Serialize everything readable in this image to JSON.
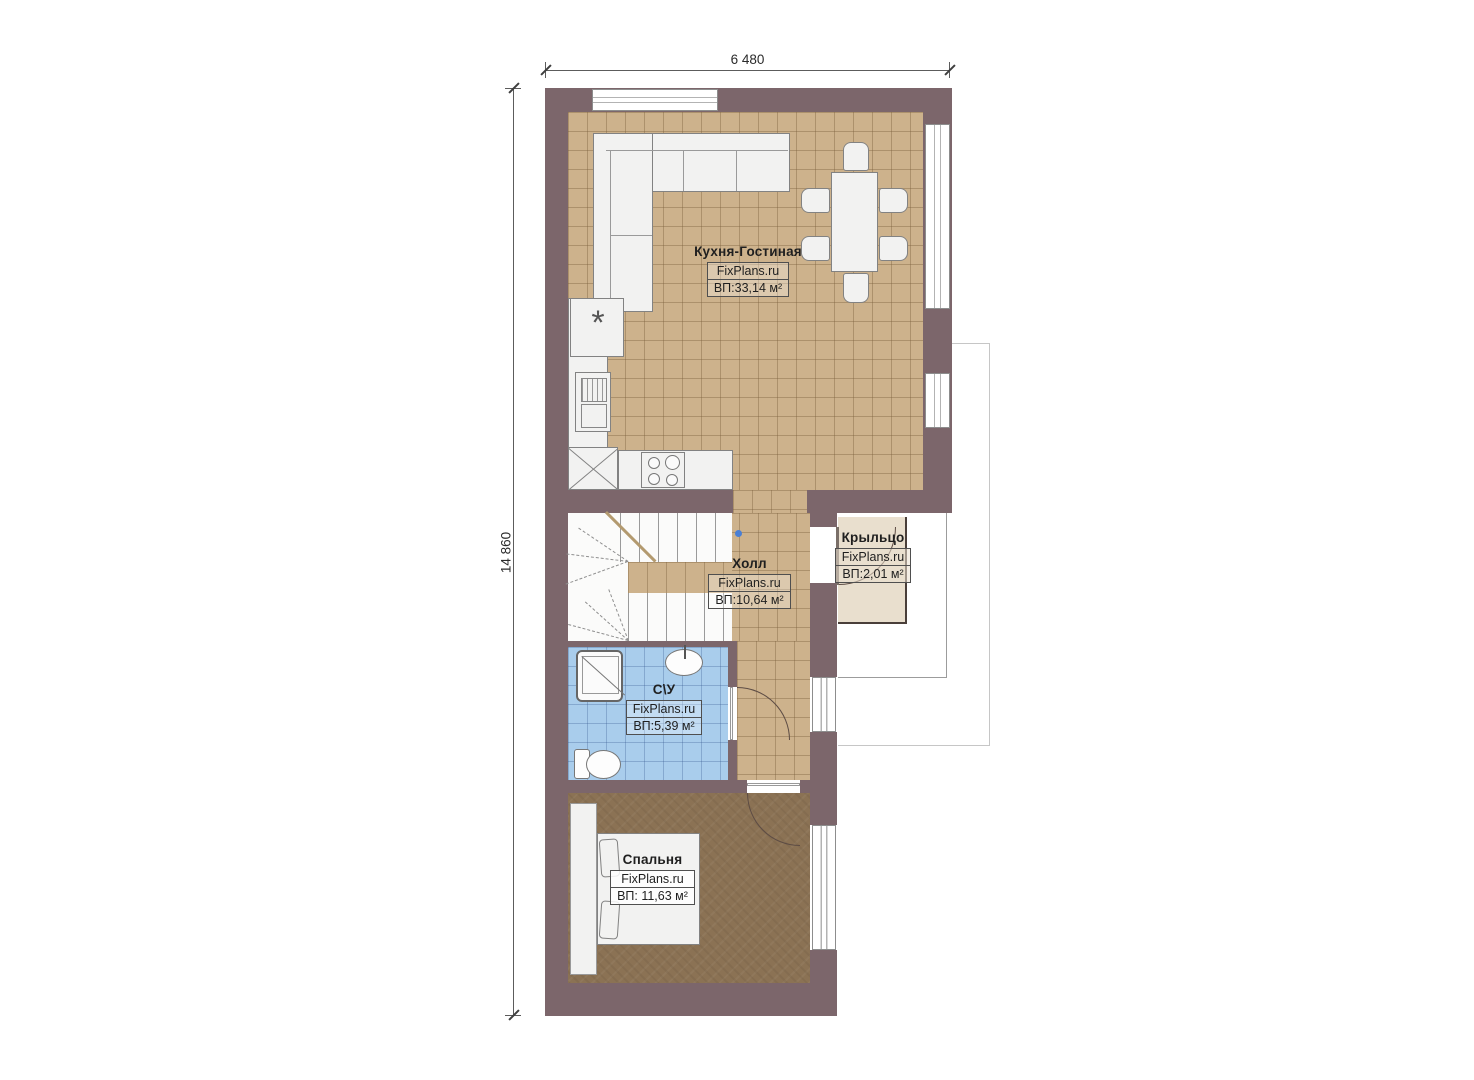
{
  "plan": {
    "dimensions": {
      "width": "6 480",
      "height": "14 860"
    },
    "rooms": [
      {
        "name": "Кухня-Гостиная",
        "brand": "FixPlans.ru",
        "area": "ВП:33,14 м²"
      },
      {
        "name": "Холл",
        "brand": "FixPlans.ru",
        "area": "ВП:10,64 м²"
      },
      {
        "name": "Крыльцо",
        "brand": "FixPlans.ru",
        "area": "ВП:2,01 м²"
      },
      {
        "name": "С\\У",
        "brand": "FixPlans.ru",
        "area": "ВП:5,39 м²"
      },
      {
        "name": "Спальня",
        "brand": "FixPlans.ru",
        "area": "ВП: 11,63 м²"
      }
    ],
    "colors": {
      "wall": "#7c666b",
      "kitchen_floor": "#cdb28c",
      "bedroom_floor": "#8b7254",
      "bathroom_floor": "#a9cdec",
      "porch_floor": "#e9dfce"
    }
  }
}
